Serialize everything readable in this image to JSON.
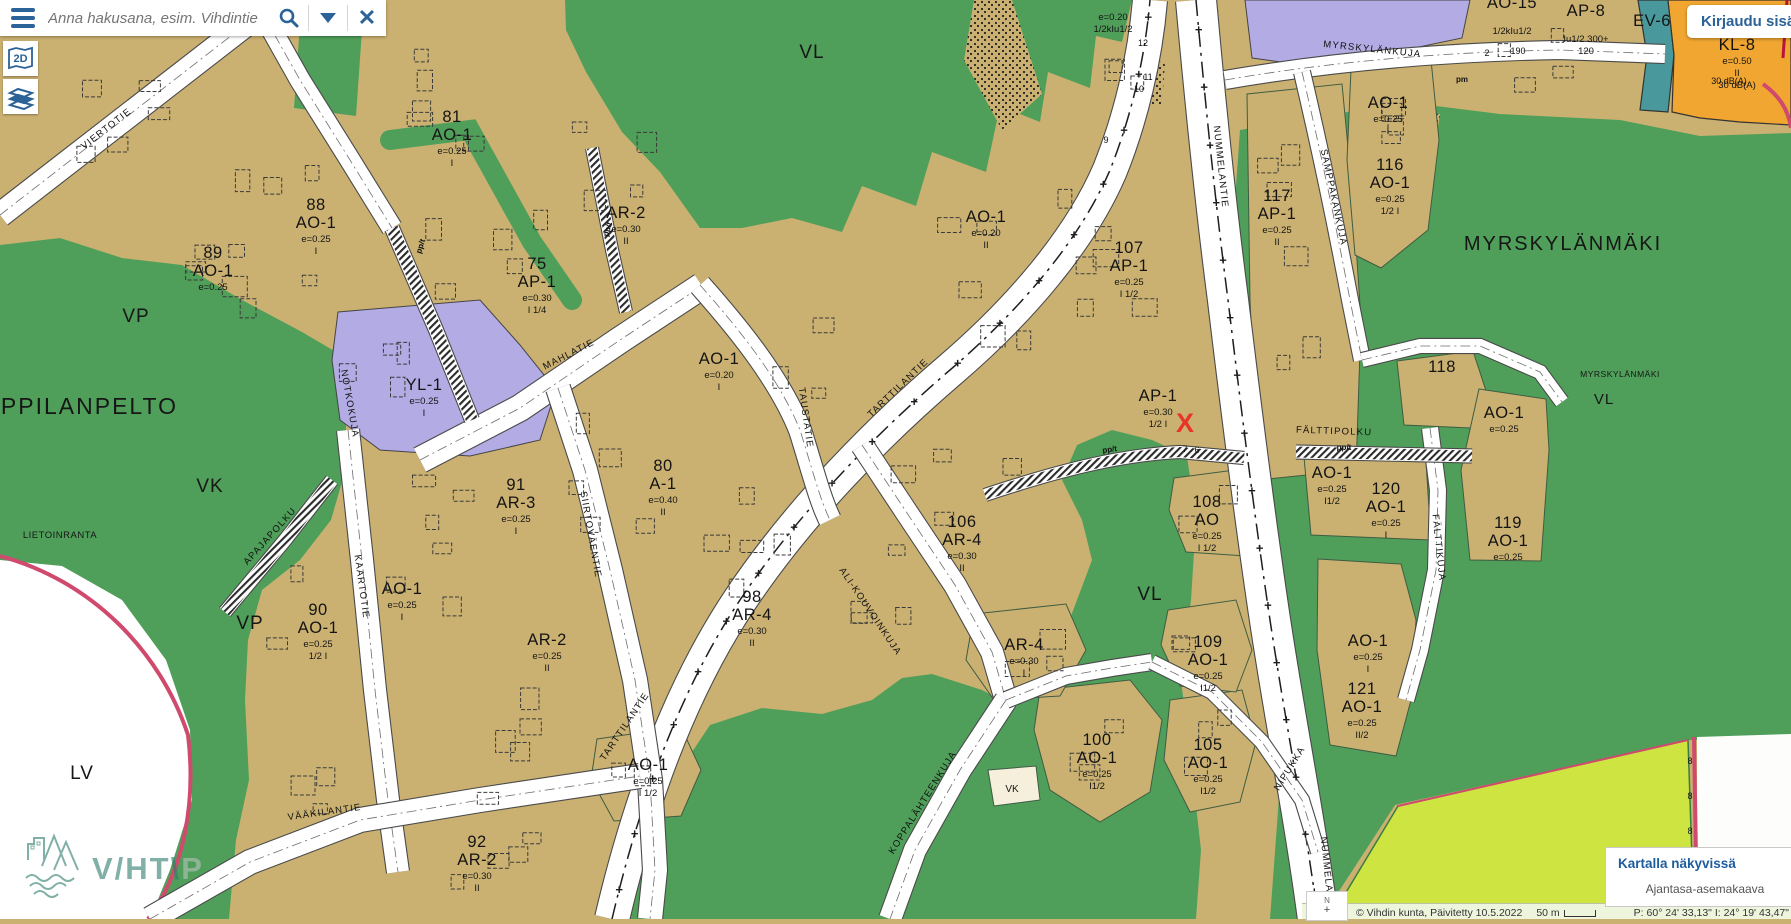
{
  "ui": {
    "search": {
      "placeholder": "Anna hakusana, esim. Vihdintie"
    },
    "login_button": "Kirjaudu sisään",
    "map_mode_button": "2D",
    "legend_panel": {
      "title": "Kartalla näkyvissä",
      "items": [
        "Ajantasa-asemakaava"
      ]
    },
    "status_bar": {
      "attribution": "© Vihdin kunta, Päivitetty 10.5.2022",
      "scale": "50 m",
      "coordinates": "P: 60° 24' 33,13\"  I: 24° 19' 43,47\"",
      "north_label": "N"
    },
    "watermark": {
      "text": "V/HT\\",
      "suffix": "P"
    }
  },
  "map": {
    "colors": {
      "residential_tan": "#cbb171",
      "park_green": "#4f9f5a",
      "field_chartreuse": "#cde441",
      "public_purple": "#b2abe4",
      "protection_teal": "#48989c",
      "commercial_orange": "#f0a630",
      "boundary_pink": "#d04a6e",
      "road_white": "#ffffff",
      "ui_blue": "#2b6297",
      "label_black": "#141414",
      "marker_red": "#e8352a"
    },
    "zones": [
      {
        "x": 452,
        "y": 140,
        "num": "81",
        "code": "AO-1",
        "e": "e=0.25",
        "fl": "I"
      },
      {
        "x": 316,
        "y": 228,
        "num": "88",
        "code": "AO-1",
        "e": "e=0.25",
        "fl": "I"
      },
      {
        "x": 213,
        "y": 276,
        "num": "89",
        "code": "AO-1",
        "e": "e=0.25",
        "fl": ""
      },
      {
        "x": 537,
        "y": 287,
        "num": "75",
        "code": "AP-1",
        "e": "e=0.30",
        "fl": "I 1/4"
      },
      {
        "x": 626,
        "y": 218,
        "num": "",
        "code": "AR-2",
        "e": "e=0.30",
        "fl": "II"
      },
      {
        "x": 424,
        "y": 390,
        "num": "",
        "code": "YL-1",
        "e": "e=0.25",
        "fl": "I"
      },
      {
        "x": 663,
        "y": 489,
        "num": "80",
        "code": "A-1",
        "e": "e=0.40",
        "fl": "II"
      },
      {
        "x": 719,
        "y": 364,
        "num": "",
        "code": "AO-1",
        "e": "e=0.20",
        "fl": "I"
      },
      {
        "x": 986,
        "y": 222,
        "num": "",
        "code": "AO-1",
        "e": "e=0.20",
        "fl": "II"
      },
      {
        "x": 516,
        "y": 508,
        "num": "91",
        "code": "AR-3",
        "e": "e=0.25",
        "fl": "I"
      },
      {
        "x": 402,
        "y": 594,
        "num": "",
        "code": "AO-1",
        "e": "e=0.25",
        "fl": "I"
      },
      {
        "x": 318,
        "y": 633,
        "num": "90",
        "code": "AO-1",
        "e": "e=0.25",
        "fl": "1/2 I"
      },
      {
        "x": 547,
        "y": 645,
        "num": "",
        "code": "AR-2",
        "e": "e=0.25",
        "fl": "II"
      },
      {
        "x": 477,
        "y": 865,
        "num": "92",
        "code": "AR-2",
        "e": "e=0.30",
        "fl": "II"
      },
      {
        "x": 648,
        "y": 770,
        "num": "",
        "code": "AO-1",
        "e": "e=0.25",
        "fl": "I 1/2"
      },
      {
        "x": 752,
        "y": 620,
        "num": "98",
        "code": "AR-4",
        "e": "e=0.30",
        "fl": "II"
      },
      {
        "x": 962,
        "y": 545,
        "num": "106",
        "code": "AR-4",
        "e": "e=0.30",
        "fl": "II"
      },
      {
        "x": 1024,
        "y": 650,
        "num": "",
        "code": "AR-4",
        "e": "e=0.30",
        "fl": "I"
      },
      {
        "x": 1097,
        "y": 763,
        "num": "100",
        "code": "AO-1",
        "e": "e=0.25",
        "fl": "I1/2"
      },
      {
        "x": 1208,
        "y": 768,
        "num": "105",
        "code": "AO-1",
        "e": "e=0.25",
        "fl": "I1/2"
      },
      {
        "x": 1208,
        "y": 665,
        "num": "109",
        "code": "AO-1",
        "e": "e=0.25",
        "fl": "I1/2"
      },
      {
        "x": 1207,
        "y": 525,
        "num": "108",
        "code": "AO",
        "e": "e=0.25",
        "fl": "I 1/2"
      },
      {
        "x": 1129,
        "y": 271,
        "num": "107",
        "code": "AP-1",
        "e": "e=0.25",
        "fl": "I 1/2"
      },
      {
        "x": 1158,
        "y": 401,
        "num": "",
        "code": "AP-1",
        "e": "e=0.30",
        "fl": "1/2 I"
      },
      {
        "x": 1277,
        "y": 219,
        "num": "117",
        "code": "AP-1",
        "e": "e=0.25",
        "fl": "II"
      },
      {
        "x": 1390,
        "y": 188,
        "num": "116",
        "code": "AO-1",
        "e": "e=0.25",
        "fl": "1/2 I"
      },
      {
        "x": 1388,
        "y": 108,
        "num": "",
        "code": "AO-1",
        "e": "e=0.25",
        "fl": "I"
      },
      {
        "x": 1442,
        "y": 390,
        "num": "118",
        "code": "",
        "e": "",
        "fl": ""
      },
      {
        "x": 1504,
        "y": 418,
        "num": "",
        "code": "AO-1",
        "e": "e=0.25",
        "fl": ""
      },
      {
        "x": 1332,
        "y": 478,
        "num": "",
        "code": "AO-1",
        "e": "e=0.25",
        "fl": "I1/2"
      },
      {
        "x": 1386,
        "y": 512,
        "num": "120",
        "code": "AO-1",
        "e": "e=0.25",
        "fl": "I"
      },
      {
        "x": 1508,
        "y": 546,
        "num": "119",
        "code": "AO-1",
        "e": "e=0.25",
        "fl": ""
      },
      {
        "x": 1368,
        "y": 646,
        "num": "",
        "code": "AO-1",
        "e": "e=0.25",
        "fl": "I"
      },
      {
        "x": 1362,
        "y": 712,
        "num": "121",
        "code": "AO-1",
        "e": "e=0.25",
        "fl": "II/2"
      },
      {
        "x": 1737,
        "y": 50,
        "num": "",
        "code": "KL-8",
        "e": "e=0.50",
        "fl": "II",
        "extra": "30 dB(A)"
      },
      {
        "x": 1586,
        "y": 16,
        "num": "",
        "code": "AP-8",
        "e": "",
        "fl": "Iu1/2 300+",
        "extra": "120"
      },
      {
        "x": 1512,
        "y": 8,
        "num": "",
        "code": "AO-15",
        "e": "",
        "fl": "1/2kIu1/2"
      },
      {
        "x": 1652,
        "y": 26,
        "num": "",
        "code": "EV-6",
        "e": "",
        "fl": ""
      },
      {
        "x": 1113,
        "y": 6,
        "num": "",
        "code": "",
        "e": "e=0.20",
        "fl": "1/2kIu1/2"
      }
    ],
    "streets": [
      {
        "x": 108,
        "y": 131,
        "r": -38,
        "name": "VIERTOTIE"
      },
      {
        "x": 570,
        "y": 357,
        "r": -27,
        "name": "MAHLATIE"
      },
      {
        "x": 803,
        "y": 418,
        "r": 82,
        "name": "TAUSTATIE"
      },
      {
        "x": 627,
        "y": 728,
        "r": -56,
        "name": "TARTTILANTIE"
      },
      {
        "x": 900,
        "y": 390,
        "r": -44,
        "name": "TARTTILANTIE"
      },
      {
        "x": 588,
        "y": 535,
        "r": 80,
        "name": "SIIRTOVÄENTIE"
      },
      {
        "x": 359,
        "y": 587,
        "r": 82,
        "name": "KAARTOTIE"
      },
      {
        "x": 272,
        "y": 538,
        "r": -48,
        "name": "APAJAPOLKU"
      },
      {
        "x": 325,
        "y": 815,
        "r": -8,
        "name": "VÄÄKILANTIE"
      },
      {
        "x": 868,
        "y": 613,
        "r": 56,
        "name": "ALI-KOUVOINKUJA"
      },
      {
        "x": 925,
        "y": 804,
        "r": -58,
        "name": "KOPPALÄHTEENKUJA"
      },
      {
        "x": 1218,
        "y": 167,
        "r": 84,
        "name": "NUMMELANTIE"
      },
      {
        "x": 1325,
        "y": 878,
        "r": 84,
        "name": "NUMMELANTIE"
      },
      {
        "x": 1372,
        "y": 52,
        "r": 6,
        "name": "MYRSKYLÄNKUJA"
      },
      {
        "x": 1331,
        "y": 198,
        "r": 78,
        "name": "SAMPPAKANKUJA"
      },
      {
        "x": 1334,
        "y": 434,
        "r": 2,
        "name": "FÄLTTIPOLKU"
      },
      {
        "x": 1436,
        "y": 548,
        "r": 84,
        "name": "FÄLTTIKUJA"
      },
      {
        "x": 1292,
        "y": 770,
        "r": -58,
        "name": "NIPUKKA"
      },
      {
        "x": 347,
        "y": 404,
        "r": 80,
        "name": "NOTKOKUJA"
      }
    ],
    "places": [
      {
        "x": 1563,
        "y": 250,
        "s": 20,
        "ls": 2,
        "name": "MYRSKYLÄNMÄKI"
      },
      {
        "x": 1620,
        "y": 377,
        "s": 8.5,
        "ls": 0.5,
        "name": "MYRSKYLÄNMÄKI"
      },
      {
        "x": 1604,
        "y": 404,
        "s": 15,
        "ls": 1,
        "name": "VL"
      },
      {
        "x": 812,
        "y": 58,
        "s": 19,
        "ls": 1,
        "name": "VL"
      },
      {
        "x": 1150,
        "y": 600,
        "s": 19,
        "ls": 1,
        "name": "VL"
      },
      {
        "x": 136,
        "y": 322,
        "s": 19,
        "ls": 1,
        "name": "VP"
      },
      {
        "x": 250,
        "y": 629,
        "s": 19,
        "ls": 1,
        "name": "VP"
      },
      {
        "x": 210,
        "y": 492,
        "s": 19,
        "ls": 1,
        "name": "VK"
      },
      {
        "x": 1012,
        "y": 792,
        "s": 10,
        "ls": 0,
        "name": "VK"
      },
      {
        "x": 82,
        "y": 779,
        "s": 19,
        "ls": 1,
        "name": "LV"
      },
      {
        "x": 60,
        "y": 538,
        "s": 9.5,
        "ls": 0.5,
        "name": "LIETOINRANTA"
      },
      {
        "x": 73,
        "y": 414,
        "s": 23,
        "ls": 2,
        "name": "PAPPILANPELTO"
      }
    ],
    "path_labels": [
      {
        "x": 423,
        "y": 247,
        "r": -72,
        "t": "pp/t"
      },
      {
        "x": 610,
        "y": 230,
        "r": -74,
        "t": "pp/t"
      },
      {
        "x": 1110,
        "y": 452,
        "r": -8,
        "t": "pp/t"
      },
      {
        "x": 1344,
        "y": 450,
        "r": 0,
        "t": "pp/t"
      },
      {
        "x": 1462,
        "y": 82,
        "r": 0,
        "t": "pm"
      }
    ],
    "lot_numbers": [
      {
        "x": 1143,
        "y": 46,
        "t": "12"
      },
      {
        "x": 1148,
        "y": 80,
        "t": "11"
      },
      {
        "x": 1139,
        "y": 92,
        "t": "10"
      },
      {
        "x": 1106,
        "y": 143,
        "t": "9"
      },
      {
        "x": 1518,
        "y": 54,
        "t": "190"
      },
      {
        "x": 1487,
        "y": 56,
        "t": "2"
      },
      {
        "x": 1185,
        "y": 452,
        "t": "7"
      },
      {
        "x": 1197,
        "y": 453,
        "t": "6"
      },
      {
        "x": 1690,
        "y": 764,
        "t": "8"
      },
      {
        "x": 1690,
        "y": 799,
        "t": "8"
      },
      {
        "x": 1690,
        "y": 834,
        "t": "8"
      },
      {
        "x": 1690,
        "y": 869,
        "t": "8"
      },
      {
        "x": 1729,
        "y": 84,
        "t": "30 dB(A)"
      }
    ],
    "markers": [
      {
        "x": 1185,
        "y": 432,
        "t": "X"
      }
    ]
  }
}
